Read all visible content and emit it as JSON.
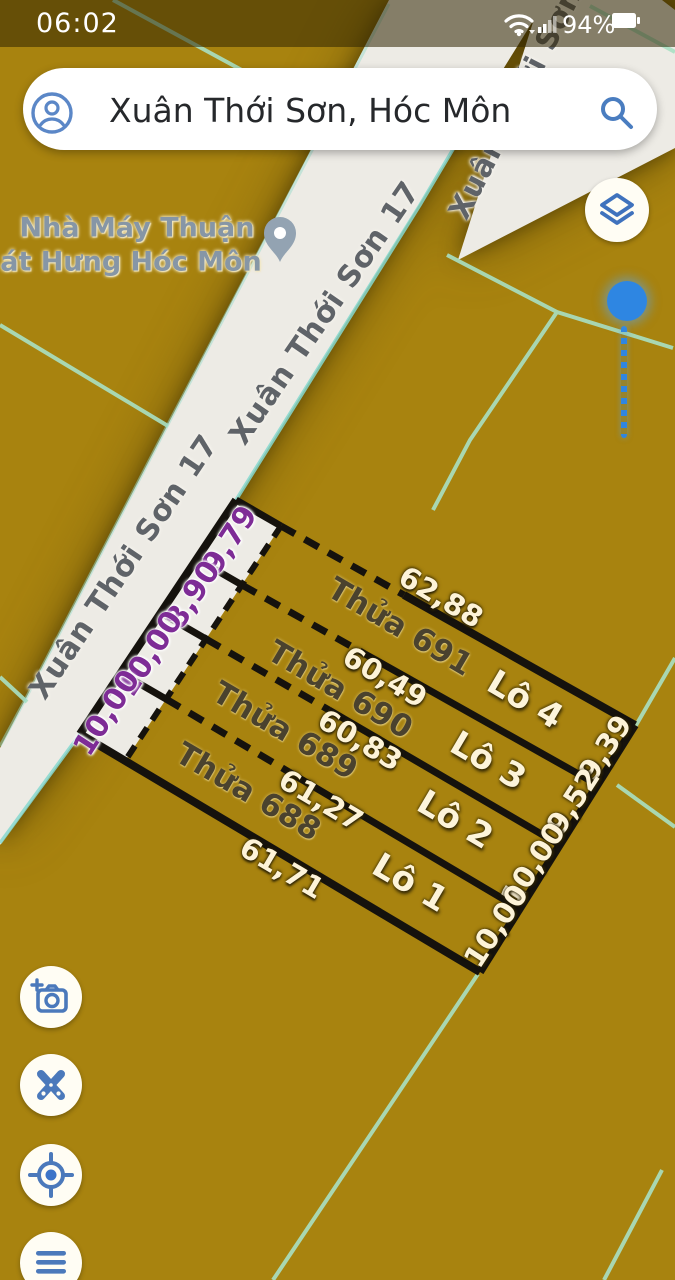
{
  "status_bar": {
    "time": "06:02",
    "battery_percent": "94%",
    "icons": {
      "wifi": "wifi-icon",
      "signal": "cellular-signal-icon",
      "battery": "battery-icon"
    }
  },
  "search_bar": {
    "query": "Xuân Thới Sơn, Hóc Môn",
    "icons": {
      "left": "account-icon",
      "right": "search-icon"
    }
  },
  "map": {
    "poi": {
      "name_line1": "Nhà Máy Thuận",
      "name_line2": "át Hưng Hóc Môn",
      "icon": "place-pin-icon"
    },
    "road_labels": {
      "main_upper": "Xuân Thới Sơn 17",
      "main_lower": "Xuân Thới Sơn 17",
      "branch": "Xuân Thới Sơn"
    },
    "parcels": {
      "strips": [
        {
          "parcel": "Thửa 691",
          "lot": "Lô 4"
        },
        {
          "parcel": "Thửa 690",
          "lot": "Lô 3"
        },
        {
          "parcel": "Thửa 689",
          "lot": "Lô 2"
        },
        {
          "parcel": "Thửa 688",
          "lot": "Lô 1"
        }
      ],
      "lengths": [
        "62,88",
        "60,49",
        "60,83",
        "61,27",
        "61,71"
      ],
      "front_widths": [
        "9,79",
        "8,90",
        "10,00",
        "10,00"
      ],
      "rear_widths": [
        "9,39",
        "9,52",
        "10,00",
        "10,00"
      ]
    },
    "colors": {
      "background": "#a8830f",
      "road": "#edebe5",
      "boundary_line": "#a9e0c3",
      "parcel_line": "#15120d",
      "front_width_text": "#7e2c96",
      "dimension_text": "#fdf3d8",
      "parcel_text": "#4a422e",
      "marker_blue": "#2e86e2",
      "control_icon_blue": "#4b79bb"
    }
  },
  "controls": {
    "layers": "layers-button",
    "add_photo": "add-photo-camera-button",
    "measure": "scissors-measure-button",
    "my_location": "my-location-button",
    "menu": "menu-button"
  }
}
